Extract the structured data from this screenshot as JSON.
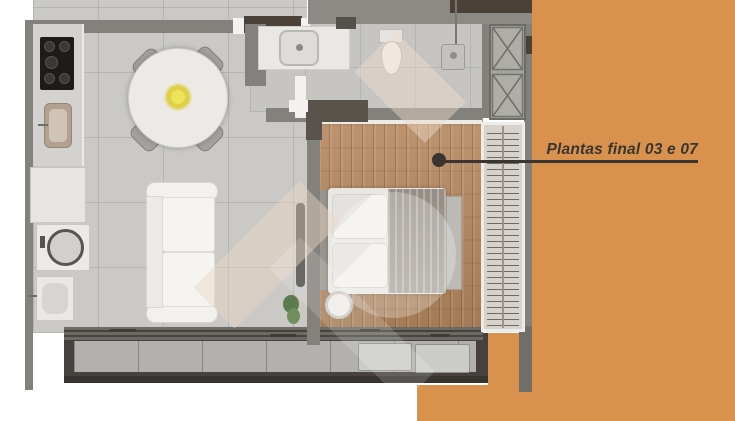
{
  "annotation": {
    "label": "Plantas final 03 e 07"
  },
  "colors": {
    "accent_orange": "#d9924d",
    "leader_line": "#3a3530",
    "annotation_text": "#3a3530"
  }
}
